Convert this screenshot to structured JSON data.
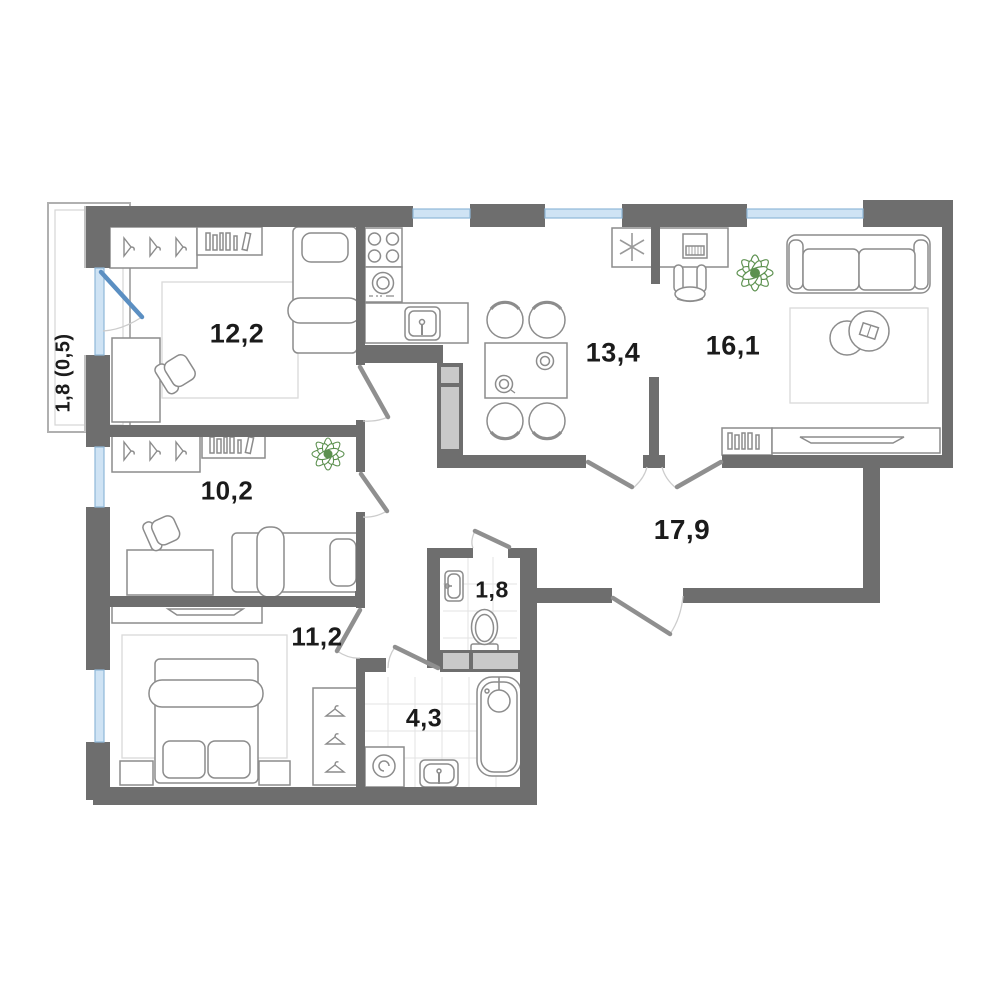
{
  "plan_title": "apartment-floor-plan",
  "balcony": {
    "id": "balcony",
    "area_label": "1,8 (0,5)"
  },
  "rooms": [
    {
      "id": "bedroom-1",
      "area_label": "12,2"
    },
    {
      "id": "kitchen-dining",
      "area_label": "13,4"
    },
    {
      "id": "living-room",
      "area_label": "16,1"
    },
    {
      "id": "hallway",
      "area_label": "17,9"
    },
    {
      "id": "bedroom-2",
      "area_label": "10,2"
    },
    {
      "id": "bedroom-3",
      "area_label": "11,2"
    },
    {
      "id": "wc",
      "area_label": "1,8"
    },
    {
      "id": "bathroom",
      "area_label": "4,3"
    }
  ],
  "icons": {
    "air-conditioner": "snowflake-asterisk",
    "plant": "leaf-cluster",
    "wardrobe": "clothes-hanger-triangle",
    "shelf": "book-spines"
  },
  "colors": {
    "wall": "#6e6e6e",
    "wall_light_face": "#c2c2c2",
    "window_fill": "#cfe3f4",
    "window_stroke": "#8fb8d8",
    "balcony_door_leaf": "#5b8fc2",
    "door_leaf": "#8f8f8f",
    "door_arc": "#cccccc",
    "shaft_fill": "#c9c9c9",
    "furniture_line": "#8c8c8c",
    "tile_line": "#e3e3e3",
    "carpet_line": "#d9d9d9",
    "plant_green": "#5d9150",
    "label_text": "#1b1b1b"
  }
}
